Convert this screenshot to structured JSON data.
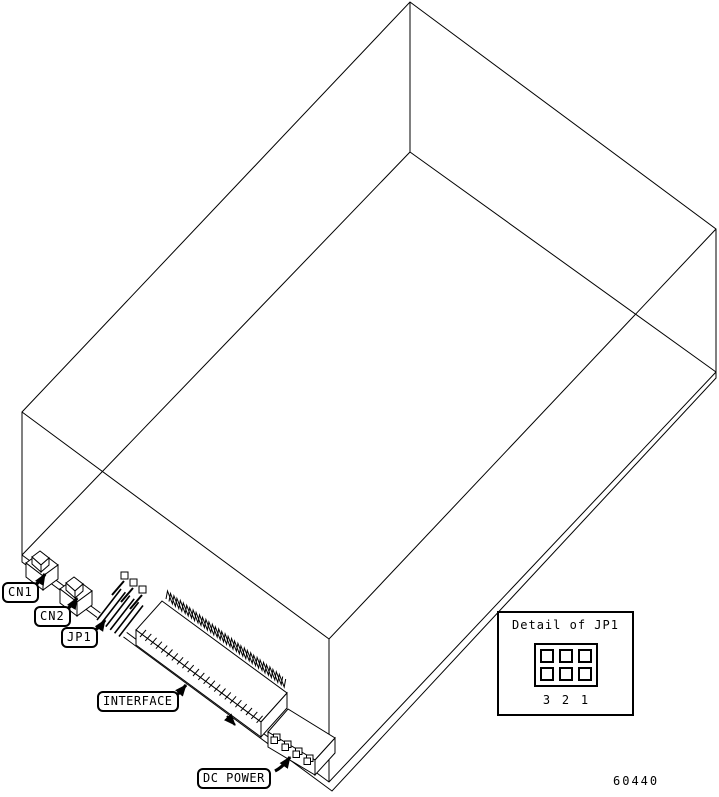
{
  "figure": {
    "callouts": {
      "cn1": "CN1",
      "cn2": "CN2",
      "jp1": "JP1",
      "interface": "INTERFACE",
      "dc_power": "DC POWER"
    },
    "detail_inset": {
      "title": "Detail of JP1",
      "pin_numbers": [
        "3",
        "2",
        "1"
      ]
    },
    "part_number": "60440",
    "colors": {
      "line": "#000000",
      "background": "#ffffff"
    }
  }
}
